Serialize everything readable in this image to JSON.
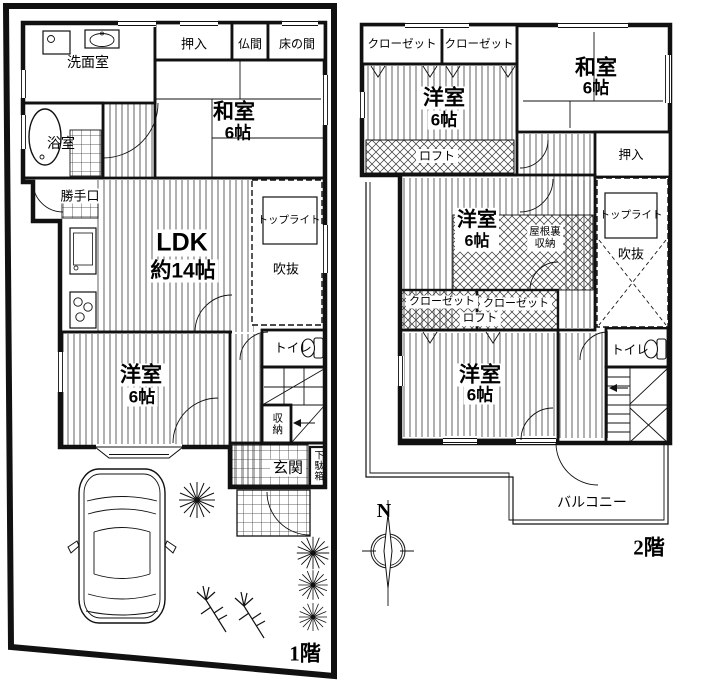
{
  "colors": {
    "line": "#111111",
    "background": "#ffffff"
  },
  "floor1": {
    "label": "1階",
    "rooms": {
      "senmen": "洗面室",
      "oshiire": "押入",
      "butsuma": "仏間",
      "tokonoma": "床の間",
      "washitsu": "和室",
      "washitsu_size": "6帖",
      "yokushitsu": "浴室",
      "katteguchi": "勝手口",
      "ldk": "LDK",
      "ldk_size": "約14帖",
      "toplight": "トップライト",
      "fukinuke": "吹抜",
      "yoshitsu": "洋室",
      "yoshitsu_size": "6帖",
      "toilet": "トイレ",
      "shuno": "収納",
      "genkan": "玄関",
      "getabako": "下駄箱"
    }
  },
  "floor2": {
    "label": "2階",
    "rooms": {
      "closet_nw1": "クローゼット",
      "closet_nw2": "クローゼット",
      "yoshitsu_n": "洋室",
      "yoshitsu_n_size": "6帖",
      "loft_n": "ロフト",
      "washitsu": "和室",
      "washitsu_size": "6帖",
      "oshiire": "押入",
      "toplight": "トップライト",
      "fukinuke": "吹抜",
      "yoshitsu_mid": "洋室",
      "yoshitsu_mid_size": "6帖",
      "yaneura_line1": "屋根裏",
      "yaneura_line2": "収納",
      "closet_s1": "クローゼット",
      "closet_s2": "クローゼット",
      "loft_s": "ロフト",
      "yoshitsu_s": "洋室",
      "yoshitsu_s_size": "6帖",
      "toilet": "トイレ",
      "balcony": "バルコニー"
    }
  },
  "compass": {
    "north_label": "N"
  }
}
